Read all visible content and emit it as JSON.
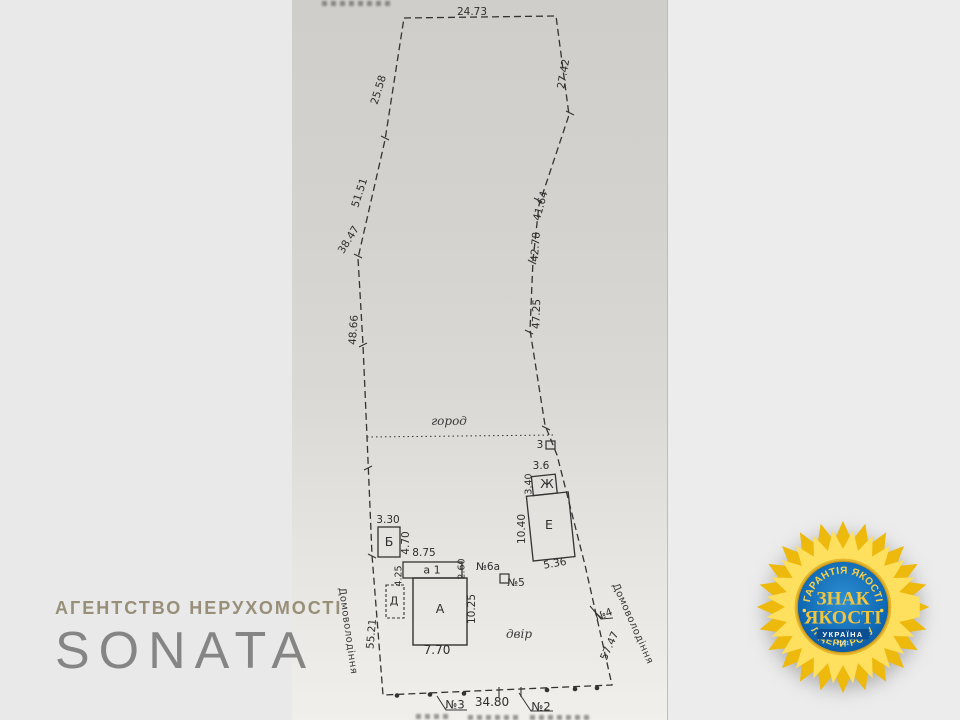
{
  "watermark": {
    "agency_line": "АГЕНТСТВО НЕРУХОМОСТІ",
    "agency_name": "SONATA"
  },
  "badge": {
    "top_arc": "ГАРАНТІЯ ЯКОСТІ",
    "title_line1": "ЗНАК",
    "title_line2": "ЯКОСТІ",
    "country": "УКРАЇНА",
    "year": "2021",
    "bottom_arc": "ЛІДЕРИ РОКУ"
  },
  "plan": {
    "area_labels": {
      "garden": "город",
      "yard": "двір"
    },
    "estate_label_left": "Домоволодіння",
    "estate_label_right": "Домоволодіння",
    "measurements": {
      "top": "24.73",
      "left1": "25.58",
      "left2": "51.51",
      "left3": "38.47",
      "left4": "48.66",
      "left5": "55.21",
      "right1": "27.42",
      "right2": "41.64",
      "right3": "42.78",
      "right4": "47.25",
      "right5": "57.47",
      "bottom": "34.80"
    },
    "buildings": {
      "A": {
        "label": "А",
        "width": "7.70",
        "height": "10.25"
      },
      "a1": {
        "label": "а 1",
        "width": "8.75",
        "height": "2.60",
        "left_side": "4.25"
      },
      "B": {
        "label": "Б",
        "width": "3.30",
        "height": "4.70"
      },
      "D": {
        "label": "Д"
      },
      "E": {
        "label": "Е",
        "height": "10.40",
        "width": "5.36"
      },
      "Zh": {
        "label": "Ж",
        "width": "3.6",
        "height": "3.40"
      },
      "Z": {
        "label": "3"
      }
    },
    "points": {
      "p2": "№2",
      "p3": "№3",
      "p4": "№4",
      "p5": "№5",
      "p6a": "№6а"
    }
  },
  "colors": {
    "ink": "#2e2e2e",
    "badge_blue": "#1069b4",
    "badge_gold": "#f2c63c",
    "petal_dark": "#edb90c",
    "petal_light": "#ffdf5e"
  }
}
